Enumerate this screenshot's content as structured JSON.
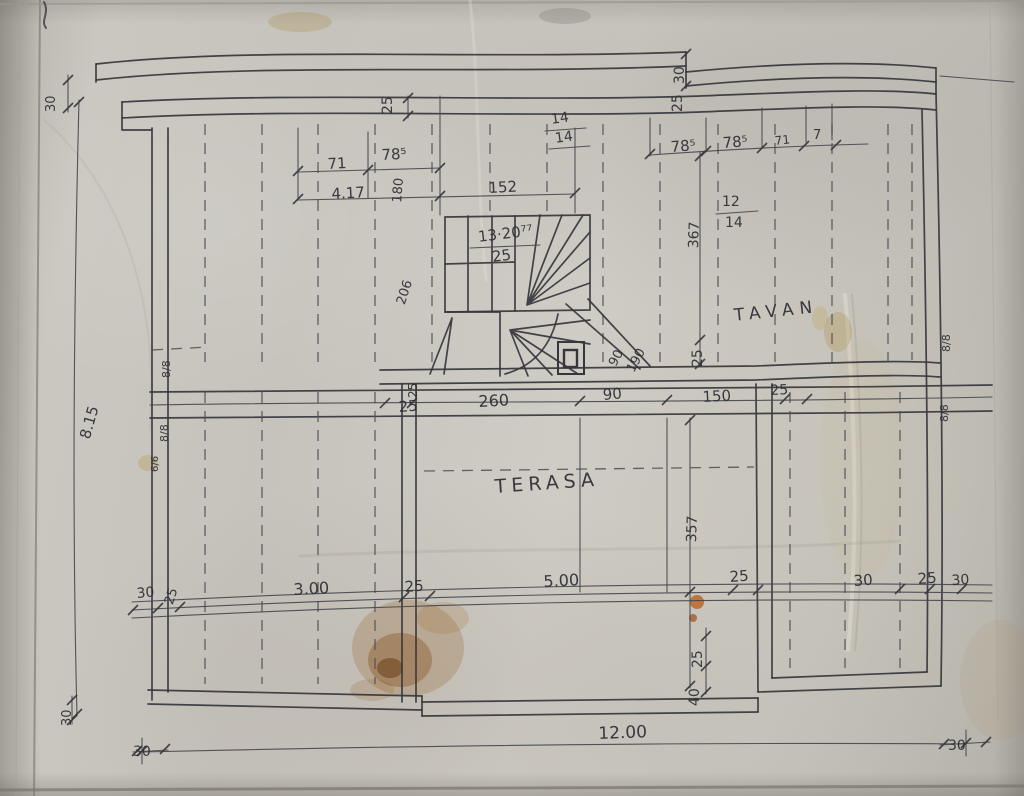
{
  "palette": {
    "paper": "#c8c5be",
    "ink": "#36363c",
    "stain_brown": "#8a5a1e"
  },
  "rooms": {
    "attic": "TAVAN",
    "terrace": "TERASA"
  },
  "stairs_note": {
    "formula": "13·20⁷⁷",
    "tread": "25"
  },
  "dims": {
    "top_left_corner": "30",
    "left_overall": "8.15",
    "wall_thickness_top": "25",
    "eave_30": "30",
    "eave_25": "25",
    "rafter_14_top": "14",
    "rafter_14_bot": "14",
    "d71_left": "71",
    "d785_left": "78⁵",
    "d180": "180",
    "d417": "4.17",
    "d152": "152",
    "d206": "206",
    "d785_mid1": "78⁵",
    "d785_mid2": "78⁵",
    "d71_right": "71",
    "d7": "7",
    "rafter_12": "12",
    "rafter_14b": "14",
    "d367": "367",
    "chimney_25": "25",
    "diag_90": "90",
    "diag_190": "190",
    "band_25_rot": "25",
    "band_25_left": "25",
    "band_260": "260",
    "band_90": "90",
    "band_150": "150",
    "band_25_right": "25",
    "timber_left_1": "8/8",
    "timber_left_2": "8/8",
    "timber_left_3": "6/6",
    "timber_right_1": "8/8",
    "timber_right_2": "8/8",
    "terrace_357": "357",
    "bot_30_1": "30",
    "bot_25_1": "25",
    "bot_300": "3.00",
    "bot_25_2": "25",
    "bot_500": "5.00",
    "bot_25_3": "25",
    "bot_30_2": "30",
    "bot_25_4": "25",
    "bot_30_3": "30",
    "v25": "25",
    "v40": "40",
    "overall_width": "12.00",
    "corner_30_v": "30",
    "corner_30_h": "30",
    "corner_30_r": "30"
  }
}
